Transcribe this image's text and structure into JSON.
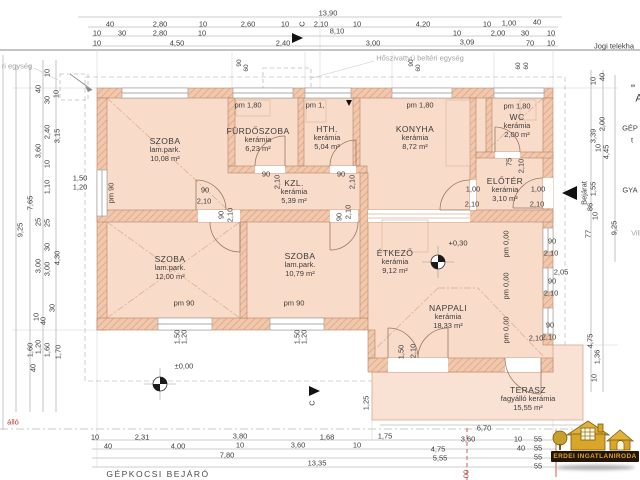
{
  "logo": {
    "text": "ERDEI INGATLANIRODA"
  },
  "plan": {
    "rooms": [
      {
        "id": "szoba-1",
        "name": "SZOBA",
        "floor": "lam.park.",
        "area": "10,08 m²",
        "x": 165,
        "y": 150
      },
      {
        "id": "furdoszoba",
        "name": "FÜRDŐSZOBA",
        "floor": "kerámia",
        "area": "6,23 m²",
        "x": 258,
        "y": 140
      },
      {
        "id": "hth",
        "name": "HTH.",
        "floor": "kerámia",
        "area": "5,04 m²",
        "x": 327,
        "y": 138
      },
      {
        "id": "konyha",
        "name": "KONYHA",
        "floor": "kerámia",
        "area": "8,72 m²",
        "x": 415,
        "y": 138
      },
      {
        "id": "wc",
        "name": "WC",
        "floor": "kerámia",
        "area": "2,00 m²",
        "x": 517,
        "y": 126
      },
      {
        "id": "eloter",
        "name": "ELŐTÉR",
        "floor": "kerámia",
        "area": "3,10 m²",
        "x": 505,
        "y": 190
      },
      {
        "id": "kozlekedo",
        "name": "KZL.",
        "floor": "kerámia",
        "area": "5,39 m²",
        "x": 294,
        "y": 192
      },
      {
        "id": "szoba-2",
        "name": "SZOBA",
        "floor": "lam.park.",
        "area": "12,00 m²",
        "x": 170,
        "y": 268
      },
      {
        "id": "szoba-3",
        "name": "SZOBA",
        "floor": "lam.park.",
        "area": "10,79 m²",
        "x": 300,
        "y": 265
      },
      {
        "id": "etkezo",
        "name": "ÉTKEZŐ",
        "floor": "kerámia",
        "area": "9,12 m²",
        "x": 395,
        "y": 262
      },
      {
        "id": "nappali",
        "name": "NAPPALI",
        "floor": "kerámia",
        "area": "18,33 m²",
        "x": 448,
        "y": 317
      },
      {
        "id": "terasz",
        "name": "TERASZ",
        "floor": "fagyálló kerámia",
        "area": "15,55 m²",
        "x": 528,
        "y": 399
      }
    ],
    "labels": [
      {
        "t": "13,90",
        "x": 328,
        "y": 13
      },
      {
        "t": "40",
        "x": 110,
        "y": 24
      },
      {
        "t": "2,80",
        "x": 160,
        "y": 24
      },
      {
        "t": "10",
        "x": 203,
        "y": 24
      },
      {
        "t": "2,60",
        "x": 248,
        "y": 24
      },
      {
        "t": "10",
        "x": 285,
        "y": 24
      },
      {
        "t": "2,10",
        "x": 321,
        "y": 24
      },
      {
        "t": "10",
        "x": 357,
        "y": 24
      },
      {
        "t": "4,20",
        "x": 423,
        "y": 24
      },
      {
        "t": "10",
        "x": 487,
        "y": 24
      },
      {
        "t": "1,00",
        "x": 509,
        "y": 23
      },
      {
        "t": "40",
        "x": 537,
        "y": 22
      },
      {
        "t": "10",
        "x": 97,
        "y": 33
      },
      {
        "t": "30",
        "x": 122,
        "y": 33
      },
      {
        "t": "2,80",
        "x": 160,
        "y": 33
      },
      {
        "t": "10",
        "x": 202,
        "y": 33
      },
      {
        "t": "8,10",
        "x": 337,
        "y": 31
      },
      {
        "t": "10",
        "x": 457,
        "y": 33
      },
      {
        "t": "2,00",
        "x": 498,
        "y": 33
      },
      {
        "t": "30",
        "x": 525,
        "y": 33
      },
      {
        "t": "10",
        "x": 551,
        "y": 33
      },
      {
        "t": "10",
        "x": 97,
        "y": 43
      },
      {
        "t": "4,50",
        "x": 177,
        "y": 43
      },
      {
        "t": "2,40",
        "x": 283,
        "y": 43
      },
      {
        "t": "3,00",
        "x": 373,
        "y": 43
      },
      {
        "t": "3,09",
        "x": 467,
        "y": 42
      },
      {
        "t": "70",
        "x": 530,
        "y": 43
      },
      {
        "t": "10",
        "x": 551,
        "y": 43
      },
      {
        "t": "Jogi telekha",
        "x": 614,
        "y": 46
      },
      {
        "t": "Hőszivattyú beltéri egység",
        "x": 420,
        "y": 58,
        "c": "g"
      },
      {
        "t": "ri egység",
        "x": 17,
        "y": 66,
        "c": "g"
      },
      {
        "t": "C",
        "x": 302,
        "y": 24,
        "r": 1
      },
      {
        "t": "90",
        "x": 240,
        "y": 63,
        "r": 1,
        "s": 6.5
      },
      {
        "t": "60",
        "x": 247,
        "y": 68,
        "r": 1,
        "s": 6.5
      },
      {
        "t": "90",
        "x": 412,
        "y": 63,
        "r": 1,
        "s": 6.5
      },
      {
        "t": "60",
        "x": 419,
        "y": 68,
        "r": 1,
        "s": 6.5
      },
      {
        "t": "60",
        "x": 519,
        "y": 66,
        "r": 1,
        "s": 6.5
      },
      {
        "t": "60",
        "x": 527,
        "y": 66,
        "r": 1,
        "s": 6.5
      },
      {
        "t": "10",
        "x": 47,
        "y": 73,
        "r": 1
      },
      {
        "t": "40",
        "x": 38,
        "y": 89,
        "r": 1
      },
      {
        "t": "30",
        "x": 47,
        "y": 100,
        "r": 1
      },
      {
        "t": "10",
        "x": 56,
        "y": 94,
        "r": 1
      },
      {
        "t": "2,40",
        "x": 47,
        "y": 132,
        "r": 1
      },
      {
        "t": "3,15",
        "x": 57,
        "y": 136,
        "r": 1
      },
      {
        "t": "3,60",
        "x": 38,
        "y": 151,
        "r": 1
      },
      {
        "t": "10",
        "x": 47,
        "y": 164,
        "r": 1
      },
      {
        "t": "1,10",
        "x": 47,
        "y": 187,
        "r": 1
      },
      {
        "t": "7,65",
        "x": 30,
        "y": 203,
        "r": 1
      },
      {
        "t": "9,25",
        "x": 20,
        "y": 230,
        "r": 1
      },
      {
        "t": "25",
        "x": 38,
        "y": 222,
        "r": 1
      },
      {
        "t": "25",
        "x": 47,
        "y": 223,
        "r": 1
      },
      {
        "t": "30",
        "x": 47,
        "y": 247,
        "r": 1
      },
      {
        "t": "3,00",
        "x": 38,
        "y": 266,
        "r": 1
      },
      {
        "t": "3,00",
        "x": 47,
        "y": 269,
        "r": 1
      },
      {
        "t": "4,30",
        "x": 57,
        "y": 258,
        "r": 1
      },
      {
        "t": "30",
        "x": 52,
        "y": 308,
        "r": 1
      },
      {
        "t": "10",
        "x": 36,
        "y": 317,
        "r": 1
      },
      {
        "t": "40",
        "x": 43,
        "y": 321,
        "r": 1
      },
      {
        "t": "1,60",
        "x": 30,
        "y": 350,
        "r": 1
      },
      {
        "t": "1,20",
        "x": 38,
        "y": 347,
        "r": 1
      },
      {
        "t": "1,60",
        "x": 47,
        "y": 350,
        "r": 1
      },
      {
        "t": "1,70",
        "x": 58,
        "y": 352,
        "r": 1
      },
      {
        "t": "40",
        "x": 33,
        "y": 368,
        "r": 1
      },
      {
        "t": "1,50",
        "x": 80,
        "y": 178
      },
      {
        "t": "1,20",
        "x": 80,
        "y": 187
      },
      {
        "t": "10",
        "x": 593,
        "y": 81,
        "r": 1
      },
      {
        "t": "40",
        "x": 602,
        "y": 77,
        "r": 1
      },
      {
        "t": "2,00",
        "x": 602,
        "y": 124,
        "r": 1
      },
      {
        "t": "3,39",
        "x": 593,
        "y": 136,
        "r": 1
      },
      {
        "t": "10",
        "x": 598,
        "y": 148,
        "r": 1
      },
      {
        "t": "4,45",
        "x": 606,
        "y": 152,
        "r": 1
      },
      {
        "t": "1,55",
        "x": 593,
        "y": 189,
        "r": 1
      },
      {
        "t": "86",
        "x": 590,
        "y": 207,
        "r": 1
      },
      {
        "t": "10",
        "x": 595,
        "y": 216,
        "r": 1
      },
      {
        "t": "9,25",
        "x": 614,
        "y": 228,
        "r": 1
      },
      {
        "t": "77",
        "x": 588,
        "y": 234,
        "r": 1
      },
      {
        "t": "4,75",
        "x": 590,
        "y": 341,
        "r": 1
      },
      {
        "t": "1,36",
        "x": 597,
        "y": 357,
        "r": 1
      },
      {
        "t": "10",
        "x": 594,
        "y": 378,
        "r": 1
      },
      {
        "t": "\"",
        "x": 633,
        "y": 89,
        "s": 12
      },
      {
        "t": "A",
        "x": 639,
        "y": 99,
        "s": 11
      },
      {
        "t": "GÉP",
        "x": 630,
        "y": 128
      },
      {
        "t": "t",
        "x": 632,
        "y": 140
      },
      {
        "t": "GYA",
        "x": 630,
        "y": 190
      },
      {
        "t": "Vill",
        "x": 636,
        "y": 233,
        "c": "g"
      },
      {
        "t": "Bejárat",
        "x": 584,
        "y": 193,
        "r": 1
      },
      {
        "t": "6,70",
        "x": 484,
        "y": 428
      },
      {
        "t": "10",
        "x": 95,
        "y": 437
      },
      {
        "t": "2,31",
        "x": 142,
        "y": 437
      },
      {
        "t": "3,80",
        "x": 240,
        "y": 436
      },
      {
        "t": "1,68",
        "x": 327,
        "y": 437
      },
      {
        "t": "1,75",
        "x": 385,
        "y": 436
      },
      {
        "t": "3,60",
        "x": 468,
        "y": 439
      },
      {
        "t": "10",
        "x": 518,
        "y": 439
      },
      {
        "t": "55",
        "x": 538,
        "y": 439
      },
      {
        "t": "40",
        "x": 108,
        "y": 446
      },
      {
        "t": "4,00",
        "x": 178,
        "y": 446
      },
      {
        "t": "10",
        "x": 240,
        "y": 445
      },
      {
        "t": "3,60",
        "x": 298,
        "y": 445
      },
      {
        "t": "10",
        "x": 357,
        "y": 445
      },
      {
        "t": "4,75",
        "x": 438,
        "y": 449
      },
      {
        "t": "40",
        "x": 521,
        "y": 448
      },
      {
        "t": "55",
        "x": 538,
        "y": 448
      },
      {
        "t": "7,80",
        "x": 227,
        "y": 455
      },
      {
        "t": "5,55",
        "x": 440,
        "y": 458
      },
      {
        "t": "55",
        "x": 538,
        "y": 457
      },
      {
        "t": "13,35",
        "x": 317,
        "y": 463
      },
      {
        "t": "55",
        "x": 538,
        "y": 466
      },
      {
        "t": "GÉPKOCSI BEJÁRÓ",
        "x": 158,
        "y": 474,
        "s": 8.5,
        "c": "sp"
      },
      {
        "t": "álló",
        "x": 13,
        "y": 422,
        "c": "red"
      },
      {
        "t": "00",
        "x": 466,
        "y": 474,
        "r": 1,
        "c": "red"
      },
      {
        "t": "pm 1,80",
        "x": 248,
        "y": 105
      },
      {
        "t": "pm 1,",
        "x": 315,
        "y": 105
      },
      {
        "t": "pm 1,80",
        "x": 420,
        "y": 105
      },
      {
        "t": "pm 1,80",
        "x": 517,
        "y": 106
      },
      {
        "t": "pm 90",
        "x": 111,
        "y": 193,
        "r": 1
      },
      {
        "t": "pm 90",
        "x": 184,
        "y": 303
      },
      {
        "t": "pm 90",
        "x": 294,
        "y": 303
      },
      {
        "t": "pm 0,00",
        "x": 506,
        "y": 244,
        "r": 1
      },
      {
        "t": "pm 0,00",
        "x": 506,
        "y": 286,
        "r": 1
      },
      {
        "t": "pm 0,00",
        "x": 506,
        "y": 330,
        "r": 1
      },
      {
        "t": "90",
        "x": 205,
        "y": 190
      },
      {
        "t": "2,10",
        "x": 204,
        "y": 201
      },
      {
        "t": "90",
        "x": 266,
        "y": 174
      },
      {
        "t": "2,10",
        "x": 277,
        "y": 182,
        "r": 1
      },
      {
        "t": "90",
        "x": 341,
        "y": 174
      },
      {
        "t": "2,10",
        "x": 352,
        "y": 182,
        "r": 1
      },
      {
        "t": "90",
        "x": 221,
        "y": 215,
        "r": 1
      },
      {
        "t": "2,10",
        "x": 230,
        "y": 215,
        "r": 1
      },
      {
        "t": "90",
        "x": 339,
        "y": 217,
        "r": 1
      },
      {
        "t": "2,10",
        "x": 348,
        "y": 212,
        "r": 1
      },
      {
        "t": "75",
        "x": 509,
        "y": 162,
        "r": 1
      },
      {
        "t": "2,10",
        "x": 521,
        "y": 166,
        "r": 1
      },
      {
        "t": "1,00",
        "x": 473,
        "y": 189
      },
      {
        "t": "2,10",
        "x": 472,
        "y": 204
      },
      {
        "t": "1,00",
        "x": 538,
        "y": 189
      },
      {
        "t": "2,10",
        "x": 537,
        "y": 204
      },
      {
        "t": "90",
        "x": 552,
        "y": 241
      },
      {
        "t": "2,10",
        "x": 551,
        "y": 253
      },
      {
        "t": "90",
        "x": 552,
        "y": 281
      },
      {
        "t": "2,10",
        "x": 551,
        "y": 293
      },
      {
        "t": "90",
        "x": 550,
        "y": 325
      },
      {
        "t": "2,10",
        "x": 549,
        "y": 337
      },
      {
        "t": "2,05",
        "x": 561,
        "y": 272
      },
      {
        "t": "1,50",
        "x": 401,
        "y": 352,
        "r": 1
      },
      {
        "t": "2,10",
        "x": 413,
        "y": 351,
        "r": 1
      },
      {
        "t": "2,10",
        "x": 536,
        "y": 338
      },
      {
        "t": "1,25",
        "x": 366,
        "y": 403,
        "r": 1
      },
      {
        "t": "±0,00",
        "x": 184,
        "y": 366
      },
      {
        "t": "+0,30",
        "x": 458,
        "y": 243
      },
      {
        "t": "1,50",
        "x": 177,
        "y": 337,
        "r": 1
      },
      {
        "t": "1,20",
        "x": 184,
        "y": 337,
        "r": 1
      },
      {
        "t": "1,50",
        "x": 297,
        "y": 337,
        "r": 1
      },
      {
        "t": "1,20",
        "x": 304,
        "y": 337,
        "r": 1
      },
      {
        "t": "C",
        "x": 312,
        "y": 403,
        "r": 1
      }
    ]
  }
}
